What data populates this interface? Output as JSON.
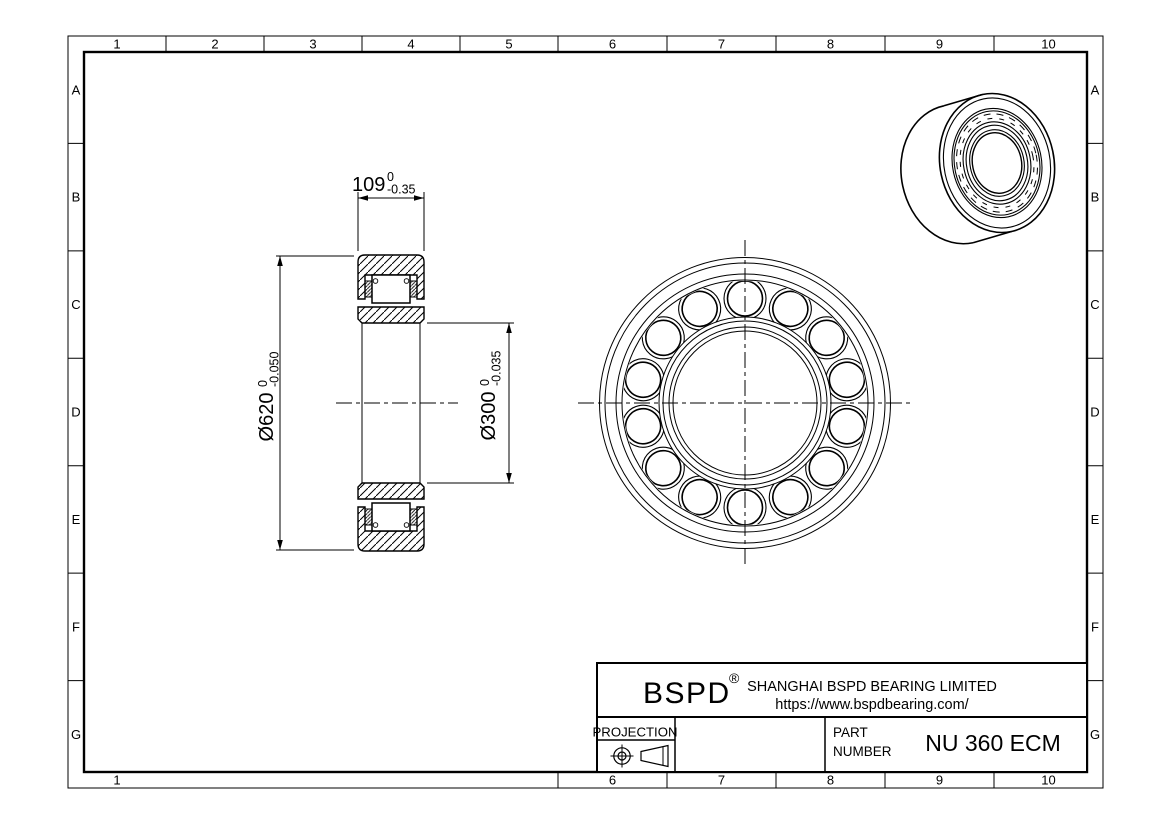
{
  "page": {
    "background": "#ffffff",
    "line_color": "#000000"
  },
  "grid": {
    "cols": [
      "1",
      "2",
      "3",
      "4",
      "5",
      "6",
      "7",
      "8",
      "9",
      "10"
    ],
    "rows": [
      "A",
      "B",
      "C",
      "D",
      "E",
      "F",
      "G"
    ]
  },
  "dimensions": {
    "width": {
      "value": "109",
      "tol_upper": "0",
      "tol_lower": "-0.35"
    },
    "outer_diameter": {
      "value": "Ø620",
      "tol_upper": "0",
      "tol_lower": "-0.050"
    },
    "bore_diameter": {
      "value": "Ø300",
      "tol_upper": "0",
      "tol_lower": "-0.035"
    }
  },
  "title_block": {
    "brand": "BSPD",
    "registered_mark": "®",
    "company": "SHANGHAI BSPD BEARING LIMITED",
    "website": "https://www.bspdbearing.com/",
    "projection_label": "PROJECTION",
    "part_label_line1": "PART",
    "part_label_line2": "NUMBER",
    "part_number": "NU 360 ECM"
  }
}
